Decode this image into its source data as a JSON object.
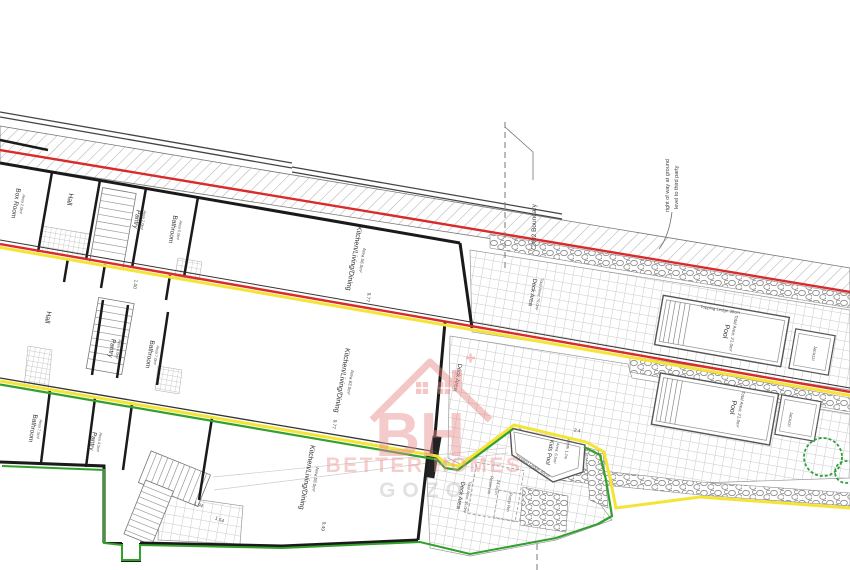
{
  "rooms": {
    "u1_box": {
      "label": "Box Room",
      "area": "Area 2.0m²"
    },
    "u1_hall": {
      "label": "Hall"
    },
    "u1_pantry": {
      "label": "Pantry",
      "area": "Area 2.0m²"
    },
    "u1_bath": {
      "label": "Bathroom",
      "area": "Area 5.0m²"
    },
    "u1_kitchen": {
      "label": "Kitchen/Living/Dining",
      "area": "Area 56.0m²"
    },
    "u2_hall": {
      "label": "Hall"
    },
    "u2_pantry": {
      "label": "Pantry",
      "area": "Area 4.0m²"
    },
    "u2_bath": {
      "label": "Bathroom",
      "area": "Area 7.0m²"
    },
    "u2_kitchen": {
      "label": "Kitchen/Living/Dining",
      "area": "Area 63.0m²"
    },
    "u3_bath": {
      "label": "Bathroom",
      "area": "Area 7.5m²"
    },
    "u3_pantry": {
      "label": "Pantry",
      "area": "Area 4.5m²"
    },
    "u3_kitchen": {
      "label": "Kitchen/Living/Dining",
      "area": "Area 58.0m²"
    }
  },
  "outdoor": {
    "deck1": {
      "label": "Deck Area",
      "area": "Total Area: 70.0m²"
    },
    "deck2": {
      "label": "Deck Area"
    },
    "deck3": {
      "label": "Deck Area",
      "area": "Total Area: 19.0m²"
    },
    "pool1": {
      "label": "Pool",
      "area": "Total Area: 21.0m²",
      "ledge": "Topping Ledge 30cm",
      "jacuzzi": "Jacuzzi"
    },
    "pool2": {
      "label": "Pool",
      "area": "Total Area: 21.0m²",
      "jacuzzi": "Jacuzzi"
    },
    "kids_pool": {
      "label": "Kids Pool",
      "area": "Area: 6.5m²",
      "depth": "depth 1.2m",
      "ledge": "Topping Ledge 40cm",
      "dim": "2.4"
    },
    "reservoir_line1": "Reservoir",
    "reservoir_line2": "24 cu.m",
    "pump_room": "Pump Rm"
  },
  "boundaries": {
    "cx02": "CX02 Boundary",
    "right_of_way_line1": "right of way at ground",
    "right_of_way_line2": "level to third party"
  },
  "dimensions": {
    "kitchen1": "9.77",
    "kitchen2": "9.77",
    "kitchen3": "9.49",
    "hallway": "1.00",
    "stair_a": "1.94",
    "stair_b": "1.54"
  },
  "watermark": {
    "monogram": "BH",
    "name": "BETTER HOMES",
    "location": "GOZO"
  },
  "colors": {
    "boundary_red": "#d92b2b",
    "boundary_yellow": "#f4e436",
    "boundary_green": "#33a02c"
  }
}
